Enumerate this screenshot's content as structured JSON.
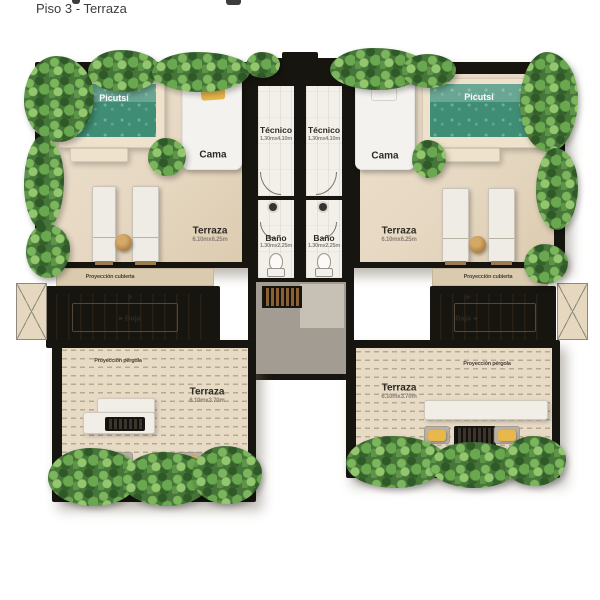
{
  "title": "Piso 3 - Terraza",
  "labels": {
    "pool": "Picutsi",
    "bed": "Cama",
    "tecnico": "Técnico",
    "tecnico_dims": "1.30mx4.10m",
    "bano": "Baño",
    "bano_dims": "1.30mx2.25m",
    "terrace": "Terraza",
    "terrace_upper_dims": "6.10mx6.25m",
    "terrace_lower_dims": "6.10mx3.70m",
    "stairs_down_left": "▸ Baja",
    "stairs_down_right": "Baja ◂",
    "roof_projection": "Proyección cubierta",
    "pergola_projection": "Proyección pérgola"
  },
  "colors": {
    "pool_water": "#3f8d75",
    "floor_cream": "#e7dac6",
    "wall_black": "#17150f",
    "foliage_green": "#5d9447",
    "accent_yellow": "#e9b84d",
    "hall_gray": "#a39c93"
  }
}
